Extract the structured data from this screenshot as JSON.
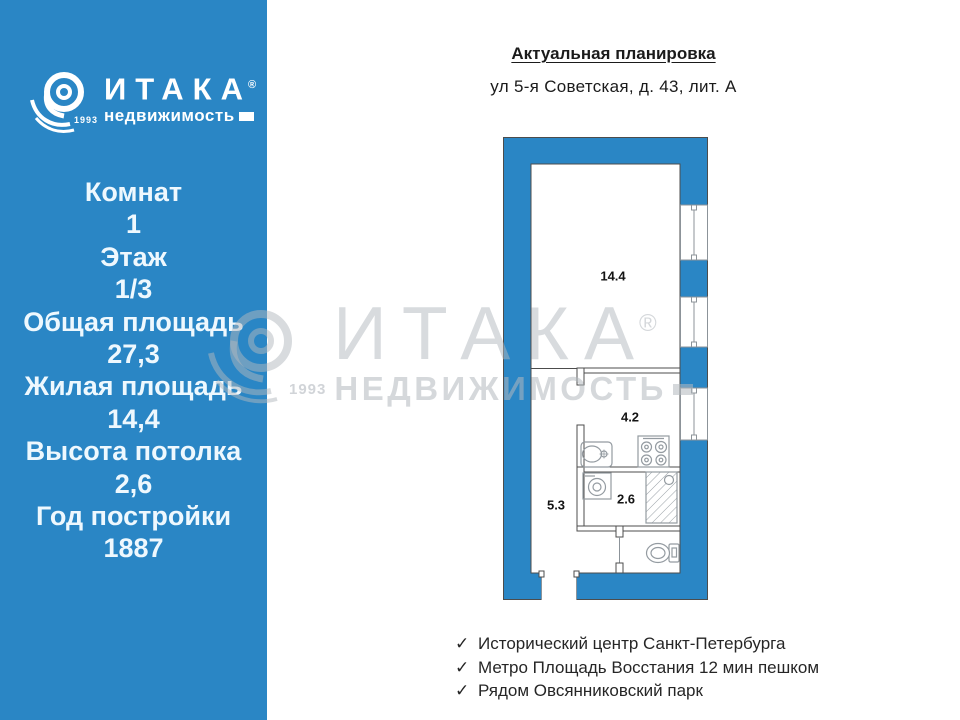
{
  "sidebar": {
    "logo": {
      "brand": "ИТАКА",
      "reg": "®",
      "sub": "недвижимость",
      "year": "1993"
    },
    "stats": [
      {
        "label": "Комнат",
        "value": "1"
      },
      {
        "label": "Этаж",
        "value": "1/3"
      },
      {
        "label": "Общая площадь",
        "value": "27,3"
      },
      {
        "label": "Жилая площадь",
        "value": "14,4"
      },
      {
        "label": "Высота потолка",
        "value": "2,6"
      },
      {
        "label": "Год постройки",
        "value": "1887"
      }
    ]
  },
  "header": {
    "title": "Актуальная планировка",
    "address": "ул 5-я Советская, д. 43, лит. А"
  },
  "floorplan": {
    "labels": {
      "room": "14.4",
      "kitchen": "4.2",
      "hall": "5.3",
      "bath": "2.6"
    }
  },
  "watermark": {
    "brand": "ИТАКА",
    "reg": "®",
    "sub": "НЕДВИЖИМОСТЬ",
    "year": "1993"
  },
  "features_check": "✓",
  "features": [
    "Исторический центр Санкт-Петербурга",
    "Метро Площадь Восстания 12 мин пешком",
    "Рядом Овсянниковский парк"
  ],
  "colors": {
    "brand_blue": "#2a86c5",
    "watermark_gray": "#b2b8be",
    "text_dark": "#1b1b1b"
  }
}
